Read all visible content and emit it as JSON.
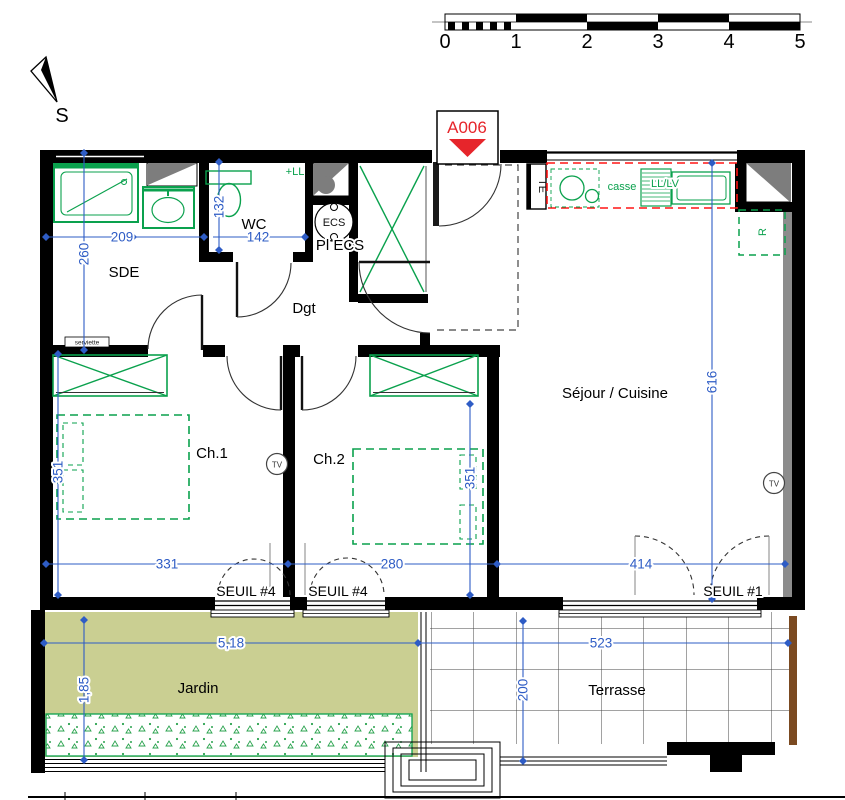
{
  "title_marker": {
    "label": "A006"
  },
  "scale_bar": {
    "ticks": [
      "0",
      "1",
      "2",
      "3",
      "4",
      "5"
    ]
  },
  "compass": {
    "south_label": "S"
  },
  "rooms": {
    "sde": "SDE",
    "wc": "WC",
    "dgt": "Dgt",
    "pl_ecs": "Pl ECS",
    "ch1": "Ch.1",
    "ch2": "Ch.2",
    "sejour_cuisine": "Séjour / Cuisine",
    "jardin": "Jardin",
    "terrasse": "Terrasse"
  },
  "equipment": {
    "ecs": "ECS",
    "te": "TE",
    "plus_ll": "+LL",
    "casse": "casse",
    "ll_lv": "LL/LV",
    "fridge": "R",
    "tv": "TV",
    "towel_radiator": "serviette"
  },
  "thresholds": {
    "ch1": "SEUIL #4",
    "ch2": "SEUIL #4",
    "sejour": "SEUIL #1"
  },
  "dims": {
    "sde_w": "209",
    "sde_h": "260",
    "wc_w": "142",
    "wc_h": "132",
    "ch1_w": "331",
    "ch1_h": "351",
    "ch2_w": "280",
    "ch2_h": "351",
    "sejour_w": "414",
    "sejour_h": "616",
    "jardin_w": "5,18",
    "jardin_h": "1,85",
    "terrasse_w": "523",
    "terrasse_h": "200"
  },
  "colors": {
    "dimension": "#2e5cc5",
    "fixture_green": "#0aa14d",
    "kitchen_red": "#ff1515",
    "marker_red": "#e6252b",
    "jardin_fill": "#cacf92",
    "wall_black": "#000000",
    "duct_gray": "#7d7d7d",
    "wood_brown": "#7b4a21"
  }
}
